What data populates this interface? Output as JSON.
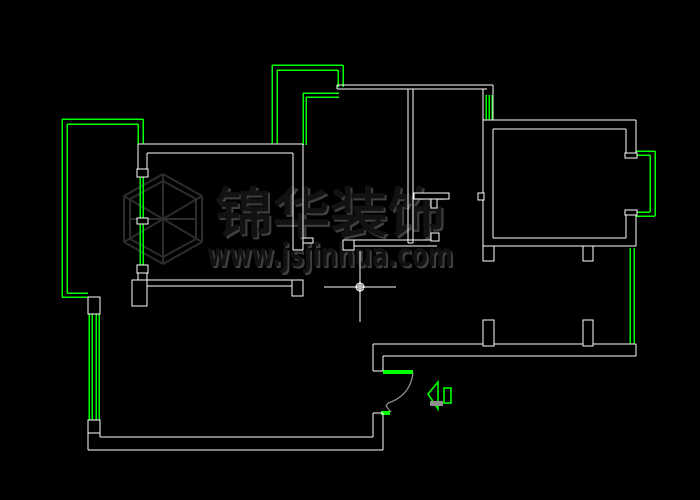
{
  "app": {
    "name": "cad-drawing-canvas",
    "background": "#000000"
  },
  "colors": {
    "wall": "#ffffff",
    "balcony": "#00ff00",
    "door_swing": "#8f8f8f",
    "watermark_dark": "#121212",
    "watermark_light": "#3f3f3f",
    "cursor": "#ffffff"
  },
  "watermark": {
    "title": "锦华装饰",
    "url": "www.jsjinhua.com"
  },
  "cursor": {
    "type": "crosshair-aperture",
    "x": 360,
    "y": 287,
    "h": [
      324,
      287,
      396,
      287
    ],
    "v": [
      360,
      251,
      360,
      322
    ],
    "r": 4
  },
  "floor_plan": {
    "white_lines": [
      [
        138,
        144,
        303,
        144
      ],
      [
        147,
        153,
        293,
        153
      ],
      [
        138,
        144,
        138,
        170
      ],
      [
        147,
        153,
        147,
        170
      ],
      [
        138,
        273,
        138,
        280
      ],
      [
        147,
        273,
        147,
        280
      ],
      [
        147,
        280,
        293,
        280
      ],
      [
        147,
        286,
        293,
        286
      ],
      [
        293,
        153,
        293,
        250
      ],
      [
        303,
        144,
        303,
        250
      ],
      [
        293,
        250,
        303,
        250
      ],
      [
        337,
        85,
        493,
        85
      ],
      [
        337,
        89,
        487,
        89
      ],
      [
        337,
        85,
        337,
        89
      ],
      [
        483,
        89,
        483,
        120
      ],
      [
        493,
        85,
        493,
        120
      ],
      [
        408,
        89,
        408,
        243
      ],
      [
        413,
        89,
        413,
        243
      ],
      [
        408,
        243,
        413,
        243
      ],
      [
        343,
        240,
        439,
        240
      ],
      [
        343,
        246,
        437,
        246
      ],
      [
        343,
        240,
        343,
        246
      ],
      [
        483,
        120,
        636,
        120
      ],
      [
        483,
        120,
        483,
        246
      ],
      [
        483,
        246,
        636,
        246
      ],
      [
        636,
        120,
        636,
        153
      ],
      [
        636,
        214,
        636,
        246
      ],
      [
        493,
        129,
        626,
        129
      ],
      [
        493,
        129,
        493,
        238
      ],
      [
        493,
        238,
        626,
        238
      ],
      [
        626,
        129,
        626,
        153
      ],
      [
        626,
        214,
        626,
        238
      ],
      [
        373,
        344,
        636,
        344
      ],
      [
        383,
        356,
        636,
        356
      ],
      [
        636,
        344,
        636,
        356
      ],
      [
        373,
        344,
        373,
        371
      ],
      [
        383,
        356,
        383,
        371
      ],
      [
        373,
        371,
        383,
        371
      ],
      [
        373,
        413,
        383,
        413
      ],
      [
        373,
        413,
        373,
        437
      ],
      [
        383,
        413,
        383,
        450
      ],
      [
        88,
        433,
        88,
        450
      ],
      [
        88,
        450,
        383,
        450
      ],
      [
        100,
        433,
        100,
        437
      ],
      [
        100,
        437,
        373,
        437
      ]
    ],
    "white_rects": [
      [
        137,
        169,
        11,
        8
      ],
      [
        137,
        218,
        11,
        6
      ],
      [
        137,
        265,
        11,
        8
      ],
      [
        132,
        280,
        15,
        26
      ],
      [
        292,
        280,
        11,
        16
      ],
      [
        303,
        238,
        10,
        5
      ],
      [
        414,
        193,
        35,
        6
      ],
      [
        431,
        199,
        6,
        9
      ],
      [
        343,
        240,
        11,
        10
      ],
      [
        431,
        233,
        8,
        8
      ],
      [
        625,
        153,
        12,
        5
      ],
      [
        625,
        210,
        12,
        5
      ],
      [
        478,
        193,
        6,
        7
      ],
      [
        483,
        246,
        11,
        15
      ],
      [
        583,
        246,
        10,
        15
      ],
      [
        483,
        320,
        11,
        26
      ],
      [
        583,
        320,
        10,
        26
      ],
      [
        88,
        297,
        12,
        17
      ],
      [
        88,
        420,
        12,
        13
      ]
    ],
    "green_lines": [
      [
        62,
        119,
        143,
        119
      ],
      [
        67,
        124,
        138,
        124
      ],
      [
        62,
        119,
        62,
        297
      ],
      [
        67,
        124,
        67,
        293
      ],
      [
        143,
        119,
        143,
        144
      ],
      [
        138,
        124,
        138,
        144
      ],
      [
        62,
        297,
        88,
        297
      ],
      [
        67,
        293,
        88,
        293
      ],
      [
        140,
        177,
        140,
        218
      ],
      [
        143,
        177,
        143,
        218
      ],
      [
        140,
        223,
        140,
        265
      ],
      [
        143,
        223,
        143,
        265
      ],
      [
        272,
        65,
        343,
        65
      ],
      [
        277,
        70,
        338,
        70
      ],
      [
        272,
        65,
        272,
        144
      ],
      [
        277,
        70,
        277,
        144
      ],
      [
        343,
        65,
        343,
        87
      ],
      [
        338,
        70,
        338,
        87
      ],
      [
        303,
        93,
        339,
        93
      ],
      [
        306,
        97,
        339,
        97
      ],
      [
        303,
        93,
        303,
        145
      ],
      [
        306,
        97,
        306,
        145
      ],
      [
        486,
        95,
        486,
        120
      ],
      [
        489,
        95,
        489,
        120
      ],
      [
        492,
        95,
        492,
        120
      ],
      [
        636,
        151,
        655,
        151
      ],
      [
        636,
        155,
        650,
        155
      ],
      [
        655,
        151,
        655,
        216
      ],
      [
        650,
        155,
        650,
        212
      ],
      [
        636,
        216,
        655,
        216
      ],
      [
        636,
        212,
        650,
        212
      ],
      [
        630,
        248,
        630,
        344
      ],
      [
        634,
        248,
        634,
        344
      ],
      [
        89,
        314,
        89,
        420
      ],
      [
        92,
        314,
        92,
        420
      ],
      [
        96,
        314,
        96,
        420
      ],
      [
        99,
        314,
        99,
        420
      ]
    ],
    "green_filled_rects": [
      [
        383,
        370,
        30,
        4
      ],
      [
        381,
        411,
        9,
        4
      ]
    ],
    "door_swing_path": "M 413,373 Q 410,396 388,403 L 386,406 L 391,412",
    "entry_arrow": {
      "head": "428,394 438,382 438,409",
      "bar": [
        430,
        401,
        13,
        5
      ],
      "tail": [
        444,
        388,
        7,
        15
      ]
    },
    "logo_lines": [
      [
        163,
        174,
        202,
        196
      ],
      [
        202,
        196,
        202,
        242
      ],
      [
        202,
        242,
        163,
        264
      ],
      [
        163,
        264,
        124,
        242
      ],
      [
        124,
        242,
        124,
        196
      ],
      [
        124,
        196,
        163,
        174
      ],
      [
        163,
        181,
        196,
        199
      ],
      [
        196,
        199,
        196,
        239
      ],
      [
        196,
        239,
        163,
        257
      ],
      [
        163,
        257,
        130,
        239
      ],
      [
        130,
        239,
        130,
        199
      ],
      [
        130,
        199,
        163,
        181
      ],
      [
        163,
        174,
        163,
        264
      ],
      [
        202,
        196,
        124,
        242
      ],
      [
        202,
        242,
        124,
        196
      ],
      [
        130,
        219,
        196,
        219
      ]
    ],
    "title_pos": {
      "x": 330,
      "y": 232,
      "size": 54,
      "textLength": 230
    },
    "url_pos": {
      "x": 330,
      "y": 266,
      "size": 32,
      "textLength": 246
    }
  }
}
